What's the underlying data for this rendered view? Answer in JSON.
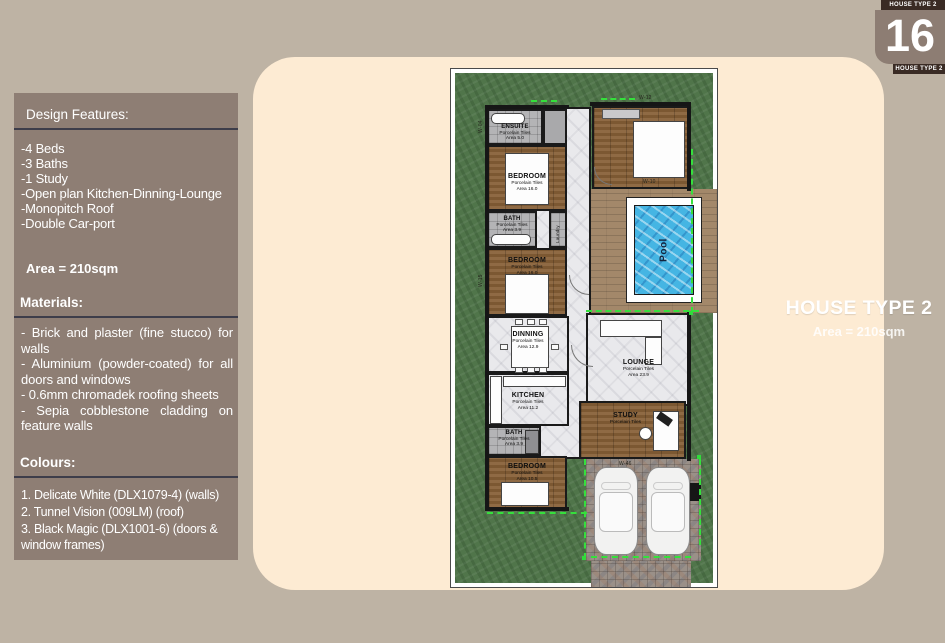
{
  "page": {
    "badge": {
      "top_label": "HOUSE TYPE 2",
      "number": "16",
      "bottom_label": "HOUSE TYPE 2"
    },
    "title": "HOUSE TYPE 2",
    "subtitle": "Area = 210sqm"
  },
  "panel": {
    "design_features": {
      "heading": "Design Features:",
      "items": [
        "-4 Beds",
        "-3 Baths",
        "-1 Study",
        "-Open plan Kitchen-Dinning-Lounge",
        "-Monopitch Roof",
        "-Double Car-port"
      ]
    },
    "area_line": "Area = 210sqm",
    "materials": {
      "heading": "Materials:",
      "items": [
        "- Brick and plaster (fine stucco) for walls",
        "- Aluminium (powder-coated) for all doors and windows",
        "- 0.6mm chromadek roofing sheets",
        "- Sepia cobblestone cladding on feature walls"
      ]
    },
    "colours": {
      "heading": "Colours:",
      "items": [
        "1. Delicate White (DLX1079-4) (walls)",
        "2. Tunnel Vision (009LM) (roof)",
        "3. Black Magic (DLX1001-6) (doors & window frames)"
      ]
    }
  },
  "plan": {
    "rooms": {
      "ensuite": {
        "name": "ENSUITE",
        "sub1": "Porcelain Tiles",
        "sub2": "Area 5.0"
      },
      "bedroom_top": {
        "name": "BEDROOM",
        "sub1": "Porcelain Tiles",
        "sub2": "Area 16.0"
      },
      "bath_mid": {
        "name": "BATH",
        "sub1": "Porcelain Tiles",
        "sub2": "Area 3.9"
      },
      "laundry": {
        "name": "Laundry"
      },
      "bedroom_mid": {
        "name": "BEDROOM",
        "sub1": "Porcelain Tiles",
        "sub2": "Area 16.0"
      },
      "dinning": {
        "name": "DINNING",
        "sub1": "Porcelain Tiles",
        "sub2": "Area 12.9"
      },
      "kitchen": {
        "name": "KITCHEN",
        "sub1": "Porcelain Tiles",
        "sub2": "Area 11.2"
      },
      "bath_bottom": {
        "name": "BATH",
        "sub1": "Porcelain Tiles",
        "sub2": "Area 3.9"
      },
      "bedroom_bottom": {
        "name": "BEDROOM",
        "sub1": "Porcelain Tiles",
        "sub2": "Area 10.5"
      },
      "lounge": {
        "name": "LOUNGE",
        "sub1": "Porcelain Tiles",
        "sub2": "Area 23.9"
      },
      "study": {
        "name": "STUDY",
        "sub1": "Porcelain Tiles"
      },
      "pool": {
        "name": "Pool"
      }
    },
    "window_labels": [
      "W-04",
      "W-15",
      "W-12",
      "W-10",
      "W-46"
    ]
  },
  "colors": {
    "background": "#beb3a4",
    "panel": "#8e7e74",
    "card": "#fdebd3",
    "badge_dark": "#3a2b24",
    "grass": "#50754a",
    "pool": "#45b5e3",
    "dash_green": "#35e03c"
  }
}
